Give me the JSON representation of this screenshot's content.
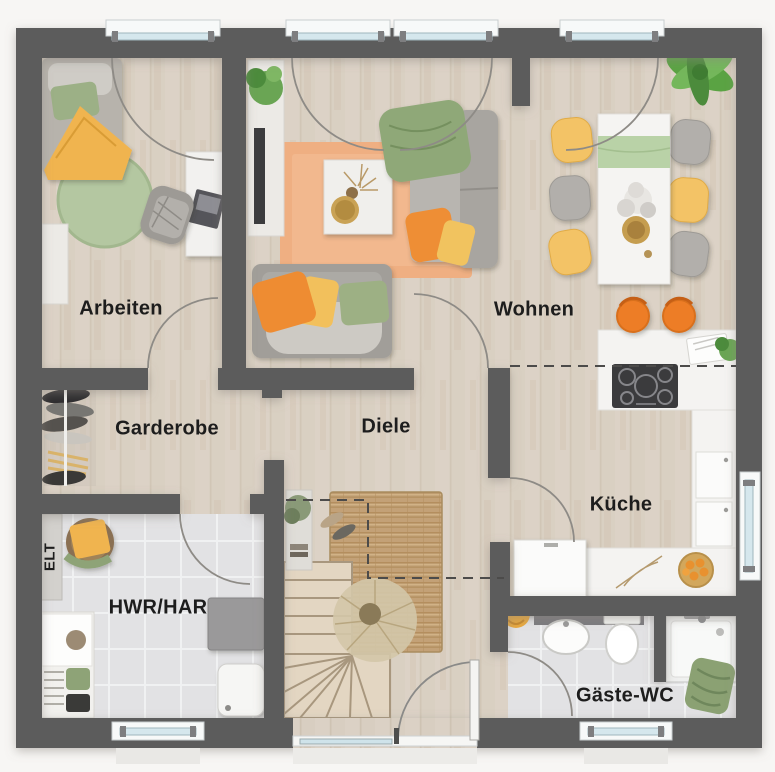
{
  "plan": {
    "title": "Ground floor plan",
    "rooms": {
      "arbeiten": "Arbeiten",
      "wohnen": "Wohnen",
      "garderobe": "Garderobe",
      "diele": "Diele",
      "kueche": "Küche",
      "hwr": "HWR/HAR",
      "gaeste_wc": "Gäste-WC",
      "elt": "ELT"
    },
    "colors": {
      "wall": "#5c5b5b",
      "wood_floor": "#d8cec1",
      "tile_floor": "#e2e2e4",
      "window_glass": "#d5e7ed",
      "accent_orange": "#ee8c33",
      "accent_yellow": "#f2c05c",
      "accent_green": "#9db084",
      "rug_orange": "#efaf82",
      "rug_jute": "#c3a177"
    }
  }
}
